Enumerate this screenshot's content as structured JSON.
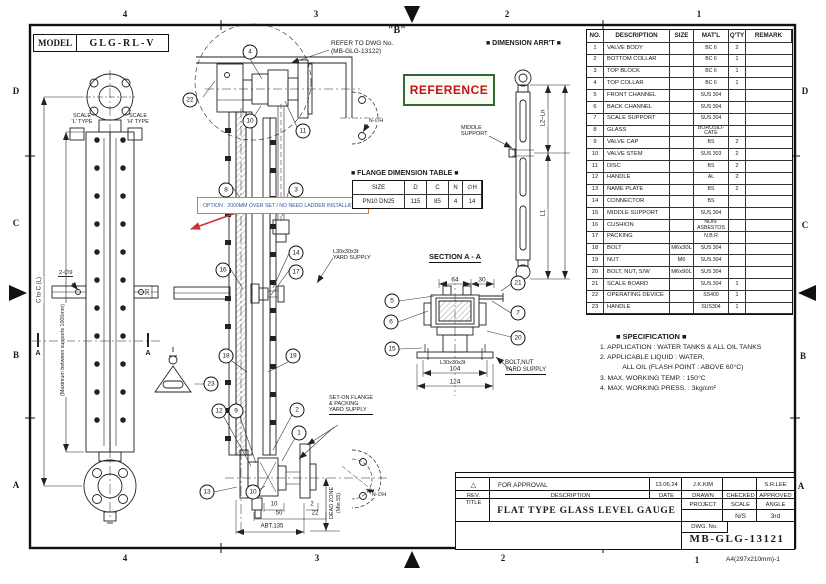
{
  "sheet": {
    "grid_top": [
      "4",
      "3",
      "2",
      "1"
    ],
    "grid_bottom": [
      "4",
      "3",
      "2",
      "1"
    ],
    "grid_left": [
      "D",
      "C",
      "B",
      "A"
    ],
    "grid_right": [
      "D",
      "C",
      "B",
      "A"
    ],
    "paper_note": "A4(297x210mm)-1"
  },
  "model_box": {
    "label": "MODEL",
    "value": "GLG-RL-V"
  },
  "left_view": {
    "scale_l1": "SCALE",
    "scale_l2": "'L' TYPE",
    "scale_h1": "SCALE",
    "scale_h2": "'H' TYPE",
    "dim_c_to_c": "C to C (L)",
    "support_note": "(Maximum between supports 1000mm)",
    "hole_note": "2-∅9",
    "dim_30": "30",
    "section_a_left": "A",
    "section_a_right": "A"
  },
  "detail_b": {
    "title": "\"B\"",
    "note1": "REFER TO DWG No.",
    "note2": "(MB-GLG-13122)"
  },
  "reference_label": "REFERENCE",
  "option_note": "OPTION : 2000MM OVER SET / NO NEED LADDER INSTALLATION",
  "dimension_arrt": {
    "title": "■ DIMENSION ARR'T ■",
    "middle_support1": "MIDDLE",
    "middle_support2": "SUPPORT",
    "dim_l2": "L2~Ln",
    "dim_l1": "L1"
  },
  "flange_table": {
    "title": "■ FLANGE DIMENSION TABLE ■",
    "headers": [
      "SIZE",
      "D",
      "C",
      "N",
      "∅H"
    ],
    "row": [
      "PN10 DN25",
      "115",
      "85",
      "4",
      "14"
    ]
  },
  "section_aa": {
    "title": "SECTION A - A",
    "dim_64": "64",
    "dim_30": "30",
    "dim_104": "104",
    "dim_124": "124",
    "angle": "L30x30x3t",
    "note1": "BOLT,NUT",
    "note2": "YARD SUPPLY"
  },
  "center_labels": {
    "l30_1": "L30x30x3t",
    "l30_2": "YARD SUPPLY",
    "seton1": "SET-ON FLANGE",
    "seton2": "& PACKING",
    "seton3": "YARD SUPPLY",
    "n_phi_h_top": "N-∅H",
    "n_phi_h_bottom": "N-∅H",
    "dead_zone1": "DEAD ZONE",
    "dead_zone2": "(Min.55)",
    "dim_10": "10",
    "dim_2": "2",
    "dim_50": "50",
    "dim_22": "22",
    "dim_abt": "ABT.135"
  },
  "balloons": [
    {
      "n": "22",
      "x": 190,
      "y": 100
    },
    {
      "n": "4",
      "x": 250,
      "y": 52
    },
    {
      "n": "10",
      "x": 250,
      "y": 121
    },
    {
      "n": "11",
      "x": 303,
      "y": 131
    },
    {
      "n": "8",
      "x": 226,
      "y": 190
    },
    {
      "n": "3",
      "x": 296,
      "y": 190
    },
    {
      "n": "14",
      "x": 296,
      "y": 253
    },
    {
      "n": "16",
      "x": 223,
      "y": 270
    },
    {
      "n": "17",
      "x": 296,
      "y": 272
    },
    {
      "n": "18",
      "x": 226,
      "y": 356
    },
    {
      "n": "19",
      "x": 293,
      "y": 356
    },
    {
      "n": "23",
      "x": 211,
      "y": 384
    },
    {
      "n": "12",
      "x": 219,
      "y": 411
    },
    {
      "n": "9",
      "x": 236,
      "y": 411
    },
    {
      "n": "2",
      "x": 297,
      "y": 410
    },
    {
      "n": "1",
      "x": 299,
      "y": 433
    },
    {
      "n": "13",
      "x": 207,
      "y": 492
    },
    {
      "n": "10",
      "x": 253,
      "y": 492
    },
    {
      "n": "5",
      "x": 392,
      "y": 301
    },
    {
      "n": "6",
      "x": 391,
      "y": 322
    },
    {
      "n": "15",
      "x": 392,
      "y": 349
    },
    {
      "n": "21",
      "x": 518,
      "y": 283
    },
    {
      "n": "7",
      "x": 518,
      "y": 313
    },
    {
      "n": "20",
      "x": 518,
      "y": 338
    }
  ],
  "parts_table": {
    "headers": [
      "NO.",
      "DESCRIPTION",
      "SIZE",
      "MAT'L",
      "Q'TY",
      "REMARK"
    ],
    "rows": [
      {
        "no": "1",
        "desc": "VALVE BODY",
        "size": "",
        "matl": "BC 6",
        "qty": "2",
        "remark": ""
      },
      {
        "no": "2",
        "desc": "BOTTOM COLLAR",
        "size": "",
        "matl": "BC 6",
        "qty": "1",
        "remark": ""
      },
      {
        "no": "3",
        "desc": "TOP BLOCK",
        "size": "",
        "matl": "BC 6",
        "qty": "1",
        "remark": ""
      },
      {
        "no": "4",
        "desc": "TOP COLLAR",
        "size": "",
        "matl": "BC 6",
        "qty": "1",
        "remark": ""
      },
      {
        "no": "5",
        "desc": "FRONT CHANNEL",
        "size": "",
        "matl": "SUS 304",
        "qty": "",
        "remark": ""
      },
      {
        "no": "6",
        "desc": "BACK CHANNEL",
        "size": "",
        "matl": "SUS 304",
        "qty": "",
        "remark": ""
      },
      {
        "no": "7",
        "desc": "SCALE SUPPORT",
        "size": "",
        "matl": "SUS 304",
        "qty": "",
        "remark": ""
      },
      {
        "no": "8",
        "desc": "GLASS",
        "size": "",
        "matl": "BOROSILI-CATE",
        "qty": "",
        "remark": ""
      },
      {
        "no": "9",
        "desc": "VALVE CAP",
        "size": "",
        "matl": "BS",
        "qty": "2",
        "remark": ""
      },
      {
        "no": "10",
        "desc": "VALVE STEM",
        "size": "",
        "matl": "SUS 303",
        "qty": "2",
        "remark": ""
      },
      {
        "no": "11",
        "desc": "DISC",
        "size": "",
        "matl": "BS",
        "qty": "2",
        "remark": ""
      },
      {
        "no": "12",
        "desc": "HANDLE",
        "size": "",
        "matl": "AL",
        "qty": "2",
        "remark": ""
      },
      {
        "no": "13",
        "desc": "NAME PLATE",
        "size": "",
        "matl": "BS",
        "qty": "2",
        "remark": ""
      },
      {
        "no": "14",
        "desc": "CONNECTOR",
        "size": "",
        "matl": "BS",
        "qty": "",
        "remark": ""
      },
      {
        "no": "15",
        "desc": "MIDDLE SUPPORT",
        "size": "",
        "matl": "SUS 304",
        "qty": "",
        "remark": ""
      },
      {
        "no": "16",
        "desc": "CUSHION",
        "size": "",
        "matl": "NON-ASBESTOS",
        "qty": "",
        "remark": ""
      },
      {
        "no": "17",
        "desc": "PACKING",
        "size": "",
        "matl": "N.B.R",
        "qty": "",
        "remark": ""
      },
      {
        "no": "18",
        "desc": "BOLT",
        "size": "M6x30L",
        "matl": "SUS 304",
        "qty": "",
        "remark": ""
      },
      {
        "no": "19",
        "desc": "NUT",
        "size": "M6",
        "matl": "SUS 304",
        "qty": "",
        "remark": ""
      },
      {
        "no": "20",
        "desc": "BOLT, NUT, S/W",
        "size": "M6x90L",
        "matl": "SUS 304",
        "qty": "",
        "remark": ""
      },
      {
        "no": "21",
        "desc": "SCALE BOARD",
        "size": "",
        "matl": "SUS 304",
        "qty": "1",
        "remark": ""
      },
      {
        "no": "22",
        "desc": "OPERATING DEVICE",
        "size": "",
        "matl": "SS400",
        "qty": "1",
        "remark": ""
      },
      {
        "no": "23",
        "desc": "HANDLE",
        "size": "",
        "matl": "SUS304",
        "qty": "1",
        "remark": ""
      }
    ]
  },
  "specification": {
    "title": "■ SPECIFICATION ■",
    "lines": [
      "1. APPLICATION : WATER TANKS & ALL OIL TANKS",
      "2. APPLICABLE LIQUID : WATER,",
      "            ALL OIL (FLASH POINT : ABOVE 60°C)",
      "3. MAX. WORKING TEMP. : 150°C",
      "4. MAX. WORKING PRESS. : 3kg/cm²"
    ]
  },
  "title_block": {
    "rev_mark": "△",
    "approval": {
      "description": "FOR APPROVAL",
      "date": "13.06.24",
      "drawn": "J.K.KIM",
      "checked": "",
      "approved": "S.R.LEE"
    },
    "headers": {
      "rev": "REV.",
      "description": "DESCRIPTION",
      "date": "DATE",
      "drawn": "DRAWN",
      "checked": "CHECKED",
      "approved": "APPROVED"
    },
    "title_label": "TITLE",
    "title": "FLAT TYPE GLASS LEVEL GAUGE",
    "project_label": "PROJECT",
    "scale_label": "SCALE",
    "angle_label": "ANGLE",
    "project_value": "",
    "scale_value": "N/S",
    "angle_value": "3rd",
    "dwg_label": "DWG. No.",
    "dwg_no": "MB-GLG-13121"
  },
  "colors": {
    "reference_red": "#c41111",
    "reference_border": "#2f6b2f",
    "option_orange": "#e07a1e",
    "option_text": "#3a55a0",
    "arrow_red": "#cc3333"
  }
}
